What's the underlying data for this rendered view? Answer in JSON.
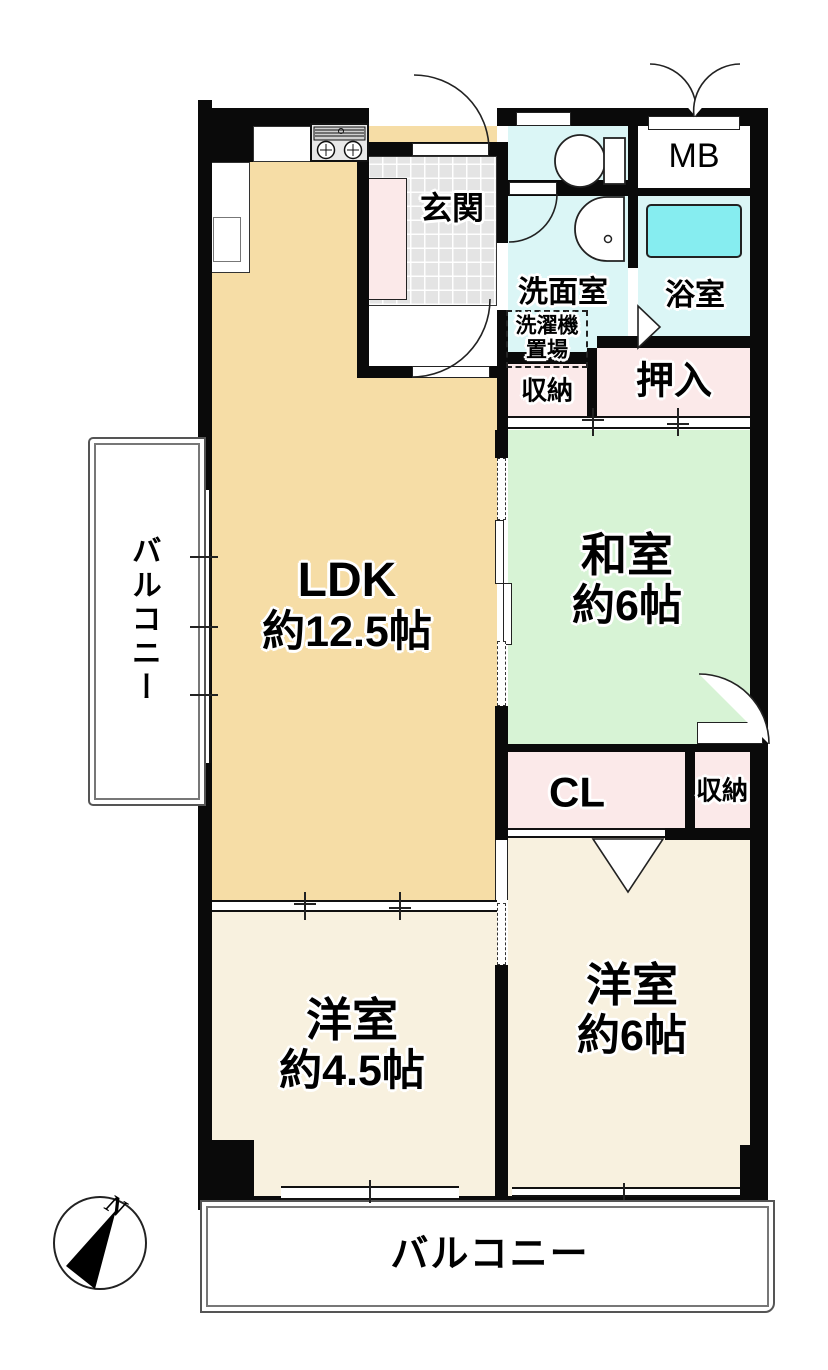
{
  "document": {
    "type": "floor-plan",
    "language": "ja"
  },
  "rooms": {
    "ldk": {
      "name": "LDK",
      "size": "約12.5帖"
    },
    "washitsu": {
      "name": "和室",
      "size": "約6帖"
    },
    "youshitsu_small": {
      "name": "洋室",
      "size": "約4.5帖"
    },
    "youshitsu_large": {
      "name": "洋室",
      "size": "約6帖"
    },
    "genkan": {
      "name": "玄関"
    },
    "senmenshitsu": {
      "name": "洗面室"
    },
    "yokushitsu": {
      "name": "浴室"
    },
    "mb": {
      "name": "MB"
    },
    "oshiire": {
      "name": "押入"
    },
    "cl": {
      "name": "CL"
    },
    "shunou_upper": {
      "name": "収納"
    },
    "shunou_lower": {
      "name": "収納"
    },
    "laundry": {
      "line1": "洗濯機",
      "line2": "置場"
    }
  },
  "balconies": {
    "left": "バルコニー",
    "bottom": "バルコニー"
  },
  "compass": {
    "north_label": "N"
  },
  "colors": {
    "wall": "#0a0a0a",
    "ldk_floor": "#f6dda6",
    "washitsu_floor": "#d7f3d5",
    "youshitsu_floor": "#f8f1df",
    "closet_pink": "#fbe9e9",
    "wet_area_cyan": "#dbf6f6",
    "bathtub_cyan": "#86edf0",
    "entrance_tile": "#e4e4e4"
  }
}
